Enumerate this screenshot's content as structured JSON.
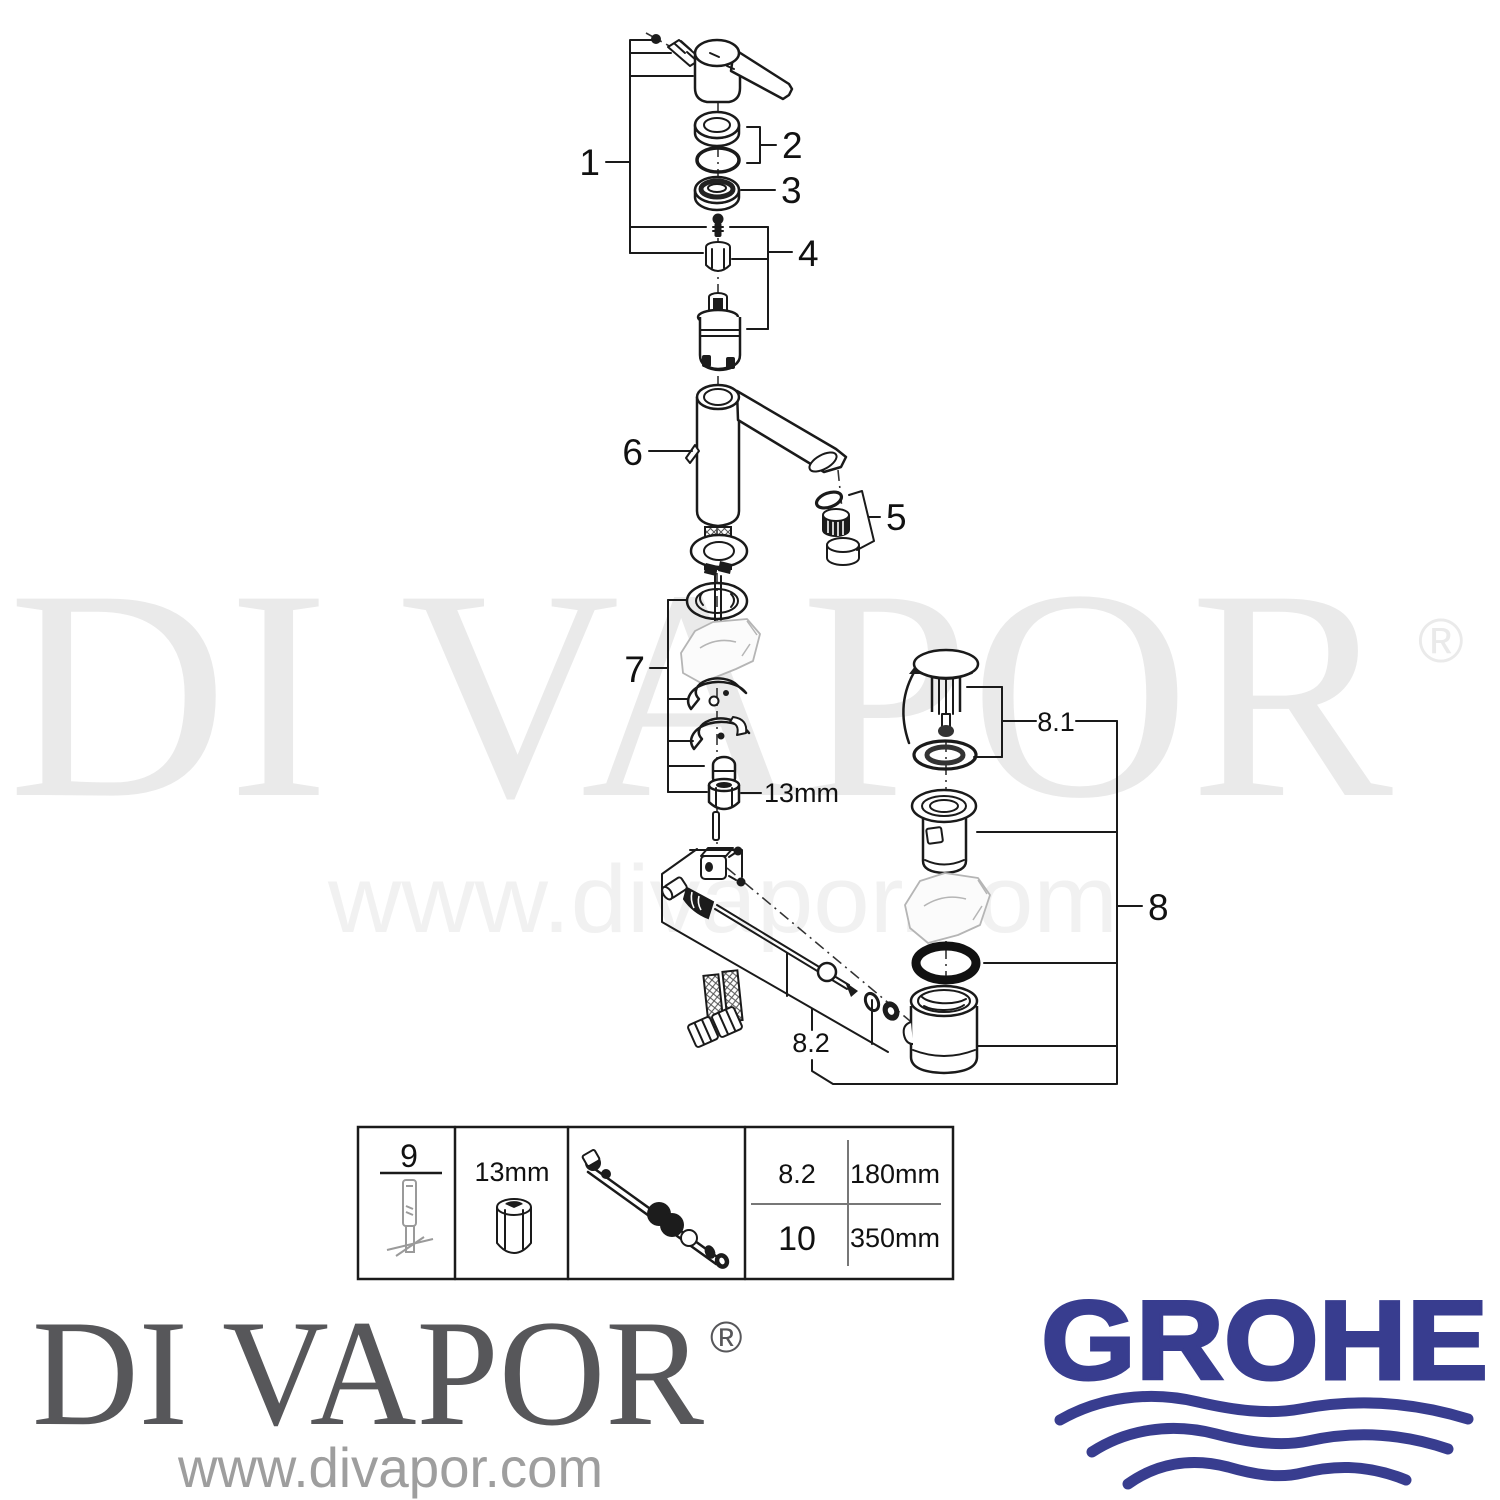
{
  "watermark": {
    "brand": "DI VAPOR",
    "registered": "®",
    "url": "www.divapor.com"
  },
  "diagram": {
    "labels": {
      "p1": "1",
      "p2": "2",
      "p3": "3",
      "p4": "4",
      "p5": "5",
      "p6": "6",
      "p7": "7",
      "p8": "8",
      "p8_1": "8.1",
      "p8_2": "8.2"
    },
    "wrench_size": "13mm"
  },
  "table": {
    "tool_ref": "9",
    "wrench_size": "13mm",
    "rows": [
      {
        "ref": "8.2",
        "length": "180mm"
      },
      {
        "ref": "10",
        "length": "350mm"
      }
    ]
  },
  "footer": {
    "brand": "DI VAPOR",
    "registered": "®",
    "url": "www.divapor.com",
    "manufacturer": "GROHE"
  },
  "colors": {
    "grohe_blue": "#383d8f",
    "line": "#1a1a1a",
    "watermark_gray": "#eaeaea",
    "logo_gray": "#57575a"
  }
}
